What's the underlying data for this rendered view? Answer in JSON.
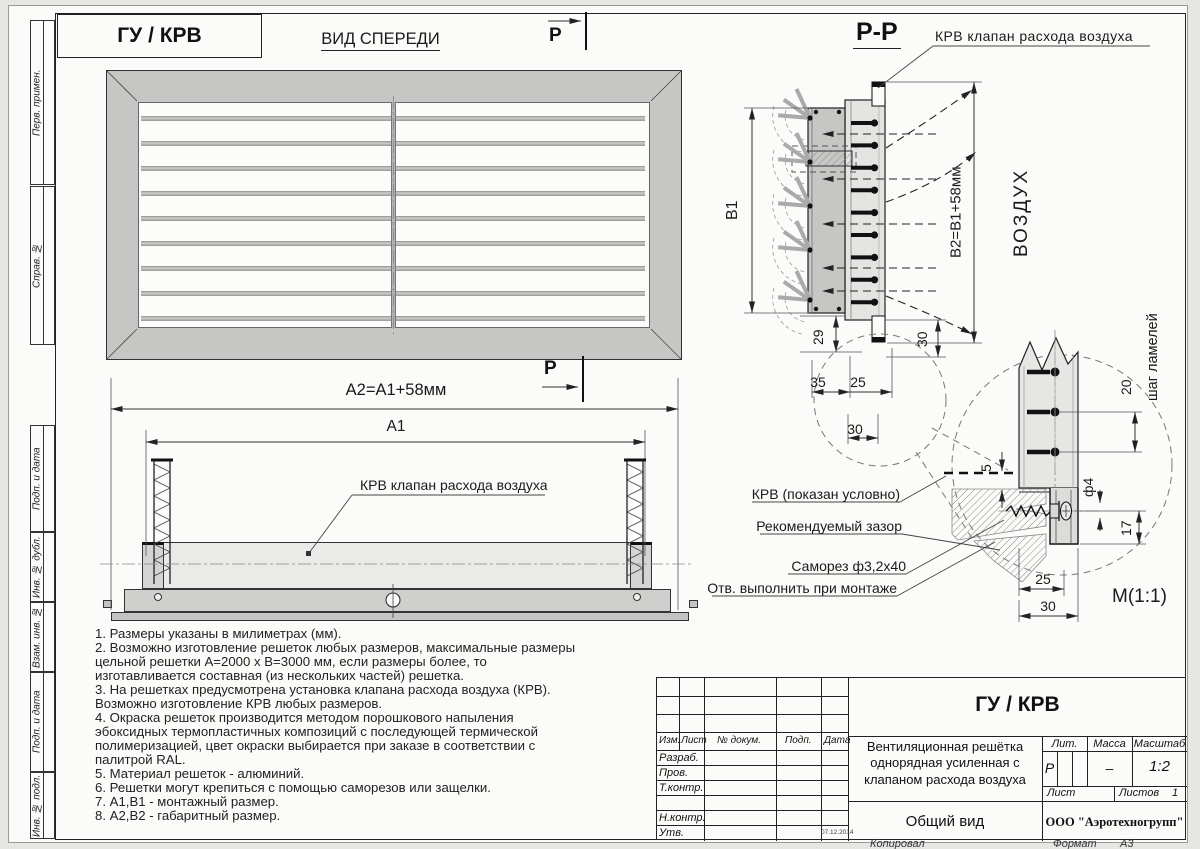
{
  "sheet": {
    "doc_code": "ГУ / КРВ",
    "kopiroval": "Копировал",
    "format_label": "Формат",
    "format_value": "А3"
  },
  "left_margin": {
    "labels": [
      "Перв. примен.",
      "Справ. №",
      "Подп. и дата",
      "Инв. № дубл.",
      "Взам. инв. №",
      "Подп. и дата",
      "Инв. № подл."
    ]
  },
  "views": {
    "front": {
      "title": "ВИД СПЕРЕДИ",
      "section_letter": "Р",
      "slat_count": 9,
      "dim_a2": "А2=А1+58мм",
      "dim_a1": "А1",
      "krv_label": "КРВ клапан расхода воздуха"
    },
    "section": {
      "title": "Р-Р",
      "krv_label": "КРВ клапан расхода воздуха",
      "dim_b1": "В1",
      "dim_b2": "В2=В1+58мм",
      "air": "ВОЗДУХ",
      "slat_count": 9,
      "dims": {
        "d29": "29",
        "d30v": "30",
        "d35": "35",
        "d25": "25",
        "d30h": "30"
      }
    },
    "detail": {
      "scale_label": "М(1:1)",
      "shag": "шаг ламелей",
      "slat_count": 3,
      "dims": {
        "d20": "20",
        "d5": "5",
        "df4": "ф4",
        "d17": "17",
        "d25": "25",
        "d30": "30"
      },
      "callouts": {
        "krv": "КРВ (показан условно)",
        "zazor": "Рекомендуемый зазор",
        "samorez": "Саморез ф3,2х40",
        "otv": "Отв. выполнить при монтаже"
      }
    }
  },
  "notes": {
    "lines": [
      "1.  Размеры указаны в милиметрах (мм).",
      "2.  Возможно изготовление решеток любых размеров, максимальные размеры",
      "цельной решетки А=2000 х В=3000 мм, если размеры более, то",
      "изготавливается  составная (из нескольких частей) решетка.",
      "3.  На решетках предусмотрена установка клапана расхода воздуха (КРВ).",
      "Возможно изготовление КРВ любых размеров.",
      "4.  Окраска решеток производится методом порошкового напыления",
      "эбоксидных термопластичных композиций с последующей термической",
      "полимеризацией, цвет окраски выбирается при заказе в соответствии с",
      "палитрой RAL.",
      "5.  Материал решеток - алюминий.",
      "6.  Решетки могут крепиться с помощью саморезов или защелки.",
      "7.  А1,В1 - монтажный размер.",
      "8.  А2,В2 - габаритный размер."
    ]
  },
  "titleblock": {
    "header_cols": [
      "Изм.",
      "Лист",
      "№ докум.",
      "Подп.",
      "Дата"
    ],
    "role_rows": [
      "Разраб.",
      "Пров.",
      "Т.контр.",
      "Н.контр.",
      "Утв."
    ],
    "date": "07.12.2014",
    "doc_code": "ГУ / КРВ",
    "product_name": "Вентиляционная решётка однорядная усиленная с клапаном расхода воздуха",
    "lit_label": "Лит.",
    "lit_value": "Р",
    "massa_label": "Масса",
    "massa_value": "–",
    "masshtab_label": "Масштаб",
    "masshtab_value": "1:2",
    "list_label": "Лист",
    "listov_label": "Листов",
    "listov_value": "1",
    "view_name": "Общий вид",
    "company": "ООО \"Аэротехногрупп\""
  },
  "colors": {
    "line": "#222222",
    "frame_fill": "#c6c6c4",
    "light_fill": "#e6e6e4"
  }
}
